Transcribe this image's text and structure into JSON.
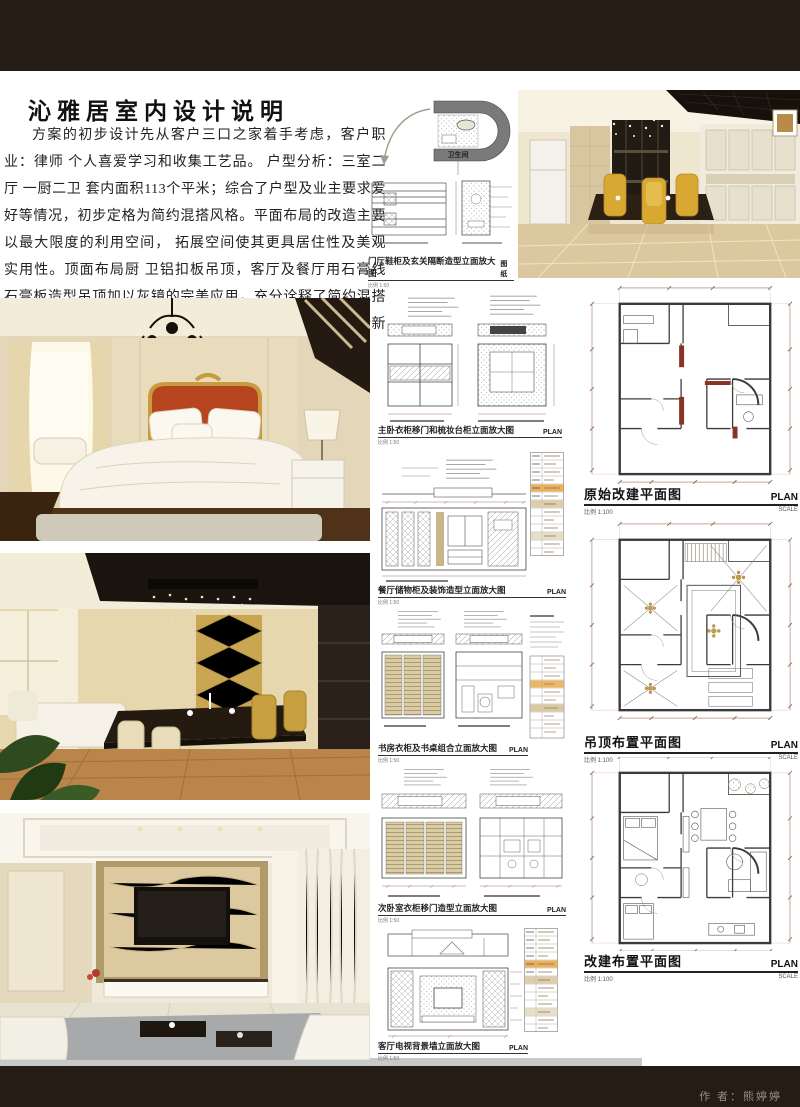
{
  "header": {
    "title": "沁雅居室内设计说明"
  },
  "intro": {
    "text": "方案的初步设计先从客户三口之家着手考虑，客户职业：律师 个人喜爱学习和收集工艺品。 户型分析：三室二厅 一厨二卫 套内面积113个平米；综合了户型及业主要求爱好等情况，初步定格为简约混搭风格。平面布局的改造主要以最大限度的利用空间， 拓展空间使其更具居住性及美观 实用性。顶面布局厨 卫铝扣板吊顶，客厅及餐厅用石膏线 石膏板造型吊顶加以灰镜的完美应用，充分诠释了简约混搭的独特风格,刻画出温馨、浪漫的家居氛围带领户主感受清新优雅的居室空间。"
  },
  "detail_panel": {
    "room_label": "卫生间",
    "caption": "门厅鞋柜及玄关隔断造型立面放大图",
    "scale": "比例 1:50",
    "sheet": "图纸",
    "sub_left": "鞋柜装饰造型 立面图",
    "sub_right": "玄关隔断 立面图"
  },
  "elevations": [
    {
      "caption": "主卧衣柜移门和梳妆台柜立面放大图",
      "scale": "比例 1:50",
      "sheet": "PLAN",
      "sub_left": "主卧衣柜移门立面放大图",
      "sub_right": "主卧梳妆台柜立面放大图"
    },
    {
      "caption": "餐厅储物柜及装饰造型立面放大图",
      "scale": "比例 1:50",
      "sheet": "PLAN",
      "sub_left": "餐厅储物柜 立面放大图",
      "sub_right": ""
    },
    {
      "caption": "书房衣柜及书桌组合立面放大图",
      "scale": "比例 1:50",
      "sheet": "PLAN",
      "sub_left": "书房衣柜立面图",
      "sub_right": "书房书桌组合立面图",
      "notes_title": "设计说明"
    },
    {
      "caption": "次卧室衣柜移门造型立面放大图",
      "scale": "比例 1:50",
      "sheet": "PLAN",
      "sub_left": "次卧衣柜移门立面放大图",
      "sub_right": "次卧衣柜内部结构图"
    },
    {
      "caption": "客厅电视背景墙立面放大图",
      "scale": "比例 1:50",
      "sheet": "PLAN",
      "sub_left": "客厅电视背景墙立面放大图",
      "sub_right": ""
    }
  ],
  "plans": [
    {
      "title": "原始改建平面图",
      "scale": "比例 1:100",
      "sheet": "PLAN",
      "sheet_sub": "SCALE"
    },
    {
      "title": "吊顶布置平面图",
      "scale": "比例 1:100",
      "sheet": "PLAN",
      "sheet_sub": "SCALE"
    },
    {
      "title": "改建布置平面图",
      "scale": "比例 1:100",
      "sheet": "PLAN",
      "sheet_sub": "SCALE"
    }
  ],
  "footer": {
    "author": "作 者：熊婷婷"
  },
  "colors": {
    "bar": "#261c16",
    "dim_line": "#a0705a",
    "wall": "#3b3b3b",
    "new_wall_red": "#8b3226",
    "tan": "#d9c8a2",
    "accent_orange": "#e0a23c"
  }
}
